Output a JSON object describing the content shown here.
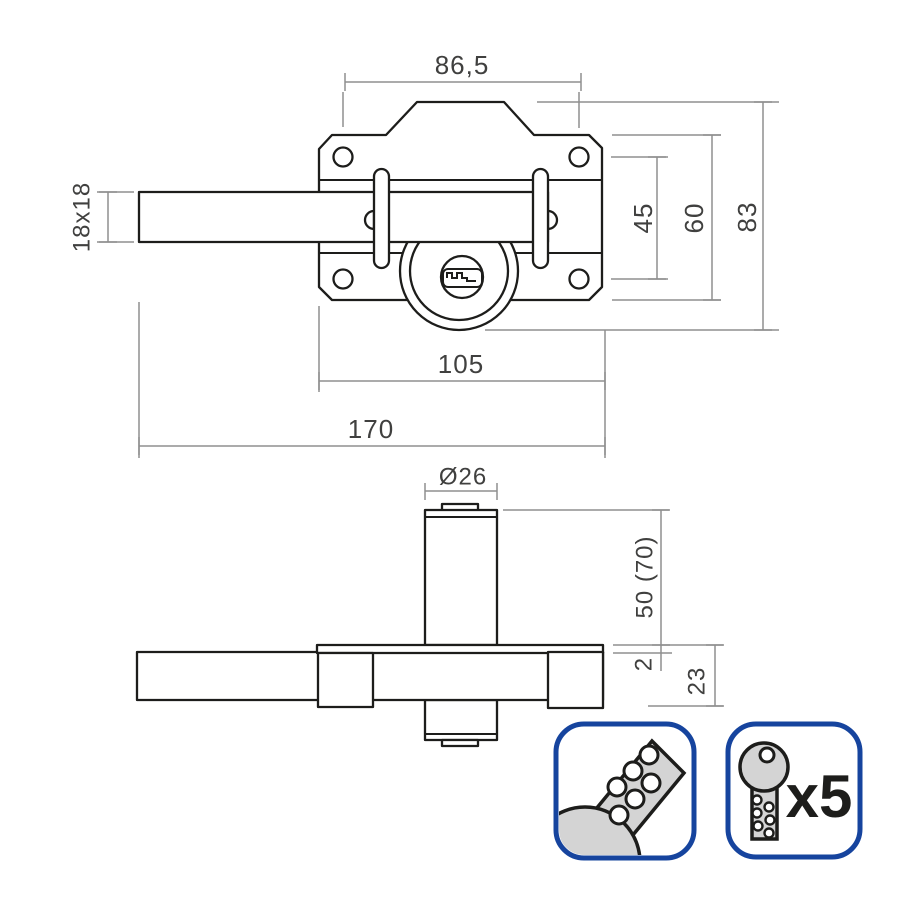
{
  "drawing": {
    "title": "lock technical drawing",
    "front_view": {
      "dims": {
        "hole_spacing_h": "86,5",
        "bolt_section": "18x18",
        "hole_spacing_v": "45",
        "plate_height": "60",
        "total_height": "83",
        "plate_width": "105",
        "total_width": "170"
      }
    },
    "side_view": {
      "dims": {
        "cylinder_diameter": "Ø26",
        "cylinder_length": "50 (70)",
        "plate_thickness": "2",
        "body_depth": "23"
      }
    }
  },
  "badges": {
    "dimple_key": {
      "icon": "dimple-key-icon"
    },
    "keys_included": {
      "icon": "key-icon",
      "label": "x5"
    }
  },
  "colors": {
    "line": "#1d1d1b",
    "dim_line": "#8f8f8f",
    "dim_text": "#40403f",
    "badge_border": "#16449e",
    "key_fill": "#d4d4d4",
    "background": "#ffffff"
  }
}
